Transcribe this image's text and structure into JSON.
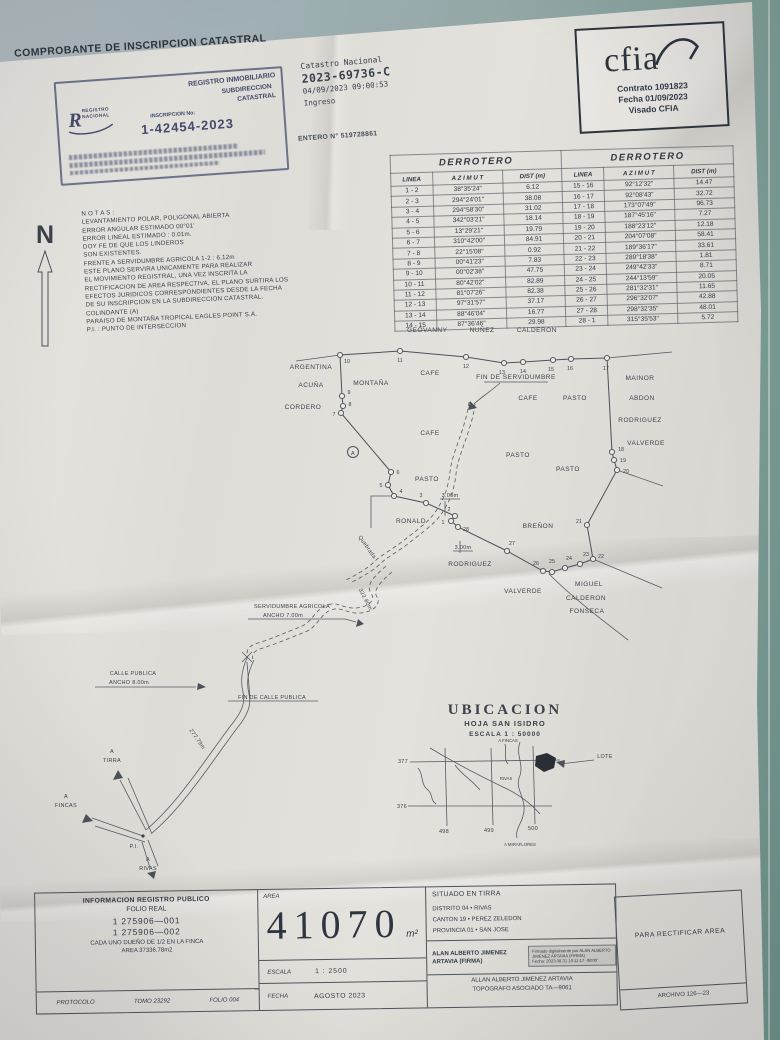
{
  "photo": {
    "surface_color": "#95a8a7",
    "paper_color": "#e0ded9",
    "ink_color": "#3c424b"
  },
  "header": {
    "title": "COMPROBANTE DE INSCRIPCION CATASTRAL",
    "stamp": {
      "org": "REGISTRO INMOBILIARIO",
      "org2": "SUBDIRECCION",
      "org3": "CATASTRAL",
      "logo1": "REGISTRO",
      "logo2": "NACIONAL",
      "inscripcion_label": "INSCRIPCION No:",
      "inscripcion_no": "1-42454-2023"
    },
    "catastro": "Catastro Nacional",
    "catastro_no": "2023-69736-C",
    "catastro_fecha": "04/09/2023 09:00:53",
    "catastro_estado": "Ingreso",
    "entero": "ENTERO N° 519728861"
  },
  "cfia": {
    "logo": "cfia",
    "contrato": "Contrato 1091823",
    "fecha": "Fecha 01/09/2023",
    "visado": "Visado CFIA"
  },
  "derrotero": {
    "title": "DERROTERO",
    "col_linea": "LINEA",
    "col_azimut": "A Z I M U T",
    "col_dist": "DIST (m)",
    "left_rows": [
      {
        "linea": "1 - 2",
        "azimut": "38°35'24\"",
        "dist": "6.12"
      },
      {
        "linea": "2 - 3",
        "azimut": "294°24'01\"",
        "dist": "38.08"
      },
      {
        "linea": "3 - 4",
        "azimut": "294°58'30\"",
        "dist": "31.02"
      },
      {
        "linea": "4 - 5",
        "azimut": "342°03'21\"",
        "dist": "18.14"
      },
      {
        "linea": "5 - 6",
        "azimut": "13°29'21\"",
        "dist": "19.79"
      },
      {
        "linea": "6 - 7",
        "azimut": "310°42'00\"",
        "dist": "84.91"
      },
      {
        "linea": "7 - 8",
        "azimut": "22°15'08\"",
        "dist": "0.92"
      },
      {
        "linea": "8 - 9",
        "azimut": "00°41'23\"",
        "dist": "7.83"
      },
      {
        "linea": "9 - 10",
        "azimut": "00°02'38\"",
        "dist": "47.75"
      },
      {
        "linea": "10 - 11",
        "azimut": "80°42'02\"",
        "dist": "82.89"
      },
      {
        "linea": "11 - 12",
        "azimut": "81°07'26\"",
        "dist": "82.38"
      },
      {
        "linea": "12 - 13",
        "azimut": "97°31'57\"",
        "dist": "37.17"
      },
      {
        "linea": "13 - 14",
        "azimut": "88°46'04\"",
        "dist": "16.77"
      },
      {
        "linea": "14 - 15",
        "azimut": "87°36'46\"",
        "dist": "29.98"
      }
    ],
    "right_rows": [
      {
        "linea": "15 - 16",
        "azimut": "92°12'32\"",
        "dist": "14.47"
      },
      {
        "linea": "16 - 17",
        "azimut": "92°08'43\"",
        "dist": "32.72"
      },
      {
        "linea": "17 - 18",
        "azimut": "173°07'49\"",
        "dist": "96.73"
      },
      {
        "linea": "18 - 19",
        "azimut": "187°45'16\"",
        "dist": "7.27"
      },
      {
        "linea": "19 - 20",
        "azimut": "188°23'12\"",
        "dist": "12.18"
      },
      {
        "linea": "20 - 21",
        "azimut": "204°07'08\"",
        "dist": "58.41"
      },
      {
        "linea": "21 - 22",
        "azimut": "189°36'17\"",
        "dist": "33.61"
      },
      {
        "linea": "22 - 23",
        "azimut": "289°18'38\"",
        "dist": "1.81"
      },
      {
        "linea": "23 - 24",
        "azimut": "249°42'33\"",
        "dist": "8.71"
      },
      {
        "linea": "24 - 25",
        "azimut": "244°13'59\"",
        "dist": "20.05"
      },
      {
        "linea": "25 - 26",
        "azimut": "281°32'31\"",
        "dist": "11.65"
      },
      {
        "linea": "26 - 27",
        "azimut": "296°32'07\"",
        "dist": "42.88"
      },
      {
        "linea": "27 - 28",
        "azimut": "298°32'35\"",
        "dist": "48.01"
      },
      {
        "linea": "28 - 1",
        "azimut": "315°35'53\"",
        "dist": "5.72"
      }
    ]
  },
  "notas": "N O T A S :\nLEVANTAMIENTO POLAR, POLIGONAL ABIERTA\nERROR ANGULAR ESTIMADO 00°01'\nERROR LINEAL ESTIMADO : 0.01m.\nDOY FE DE QUE LOS LINDEROS\nSON EXISTENTES.\nFRENTE A SERVIDUMBRE AGRICOLA 1-2 : 6.12m\nESTE PLANO SERVIRA UNICAMENTE PARA REALIZAR\nEL MOVIMIENTO REGISTRAL, UNA VEZ INSCRITA LA\nRECTIFICACION DE AREA RESPECTIVA, EL PLANO SURTIRA LOS\nEFECTOS JURIDICOS CORRESPONDIENTES DESDE LA FECHA\nDE SU INSCRIPCION EN LA SUBDIRECCION CATASTRAL.\nCOLINDANTE (A)\nPARAISO DE MONTAÑA TROPICAL EAGLES POINT S.A.\nP.I. : PUNTO DE INTERSECCION",
  "map": {
    "owner_top": "GEOVANNY NUÑEZ CALDERON",
    "labels": {
      "north": "N",
      "argentina": "ARGENTINA",
      "acuna": "ACUÑA",
      "cordero": "CORDERO",
      "montana": "MONTAÑA",
      "cafe1": "CAFE",
      "cafe2": "CAFE",
      "cafe3": "CAFE",
      "fin_servidumbre": "FIN DE SERVIDUMBRE",
      "pasto1": "PASTO",
      "pasto2": "PASTO",
      "pasto3": "PASTO",
      "pasto4": "PASTO",
      "mainor": "MAINOR",
      "abdon": "ABDON",
      "rodriguez_r": "RODRIGUEZ",
      "valverde_r": "VALVERDE",
      "ronald": "RONALD",
      "brenon": "BREÑON",
      "rodriguez_b": "RODRIGUEZ",
      "valverde_b": "VALVERDE",
      "miguel": "MIGUEL",
      "calderon": "CALDERON",
      "fonseca": "FONSECA",
      "serv1": "SERVIDUMBRE AGRICOLA",
      "serv2": "ANCHO 7.00m",
      "d322": "322.80m",
      "calle1": "CALLE PUBLICA",
      "calle2": "ANCHO 8.00m",
      "fin_calle": "FIN DE CALLE PUBLICA",
      "d277": "277.79m",
      "d3a": "3.00m",
      "d3b": "3.00m",
      "quebrada": "Quebrada",
      "colindante_a": "A",
      "a1": "A",
      "tirra": "TIRRA",
      "a2": "A",
      "fincas": "FINCAS",
      "a3": "A",
      "rivas": "RIVAS",
      "pi": "P.I."
    },
    "points": [
      {
        "n": "1",
        "x": 451,
        "y": 521,
        "lx": 443,
        "ly": 524
      },
      {
        "n": "2",
        "x": 455,
        "y": 516,
        "lx": 449,
        "ly": 511
      },
      {
        "n": "3",
        "x": 426,
        "y": 503,
        "lx": 421,
        "ly": 497
      },
      {
        "n": "4",
        "x": 394,
        "y": 496,
        "lx": 401,
        "ly": 493
      },
      {
        "n": "5",
        "x": 388,
        "y": 485,
        "lx": 381,
        "ly": 487
      },
      {
        "n": "6",
        "x": 391,
        "y": 472,
        "lx": 398,
        "ly": 474
      },
      {
        "n": "7",
        "x": 341,
        "y": 413,
        "lx": 334,
        "ly": 416
      },
      {
        "n": "8",
        "x": 343,
        "y": 406,
        "lx": 350,
        "ly": 406
      },
      {
        "n": "9",
        "x": 342,
        "y": 396,
        "lx": 349,
        "ly": 394
      },
      {
        "n": "10",
        "x": 340,
        "y": 355,
        "lx": 347,
        "ly": 363
      },
      {
        "n": "11",
        "x": 400,
        "y": 351,
        "lx": 400,
        "ly": 362
      },
      {
        "n": "12",
        "x": 466,
        "y": 357,
        "lx": 466,
        "ly": 368
      },
      {
        "n": "13",
        "x": 504,
        "y": 363,
        "lx": 502,
        "ly": 374
      },
      {
        "n": "14",
        "x": 523,
        "y": 362,
        "lx": 523,
        "ly": 373
      },
      {
        "n": "15",
        "x": 553,
        "y": 360,
        "lx": 551,
        "ly": 371
      },
      {
        "n": "16",
        "x": 571,
        "y": 359,
        "lx": 570,
        "ly": 370
      },
      {
        "n": "17",
        "x": 607,
        "y": 358,
        "lx": 606,
        "ly": 370
      },
      {
        "n": "18",
        "x": 612,
        "y": 452,
        "lx": 621,
        "ly": 451
      },
      {
        "n": "19",
        "x": 614,
        "y": 460,
        "lx": 623,
        "ly": 462
      },
      {
        "n": "20",
        "x": 617,
        "y": 470,
        "lx": 626,
        "ly": 473
      },
      {
        "n": "21",
        "x": 587,
        "y": 525,
        "lx": 579,
        "ly": 523
      },
      {
        "n": "22",
        "x": 593,
        "y": 559,
        "lx": 601,
        "ly": 558
      },
      {
        "n": "23",
        "x": 580,
        "y": 564,
        "lx": 586,
        "ly": 556
      },
      {
        "n": "24",
        "x": 565,
        "y": 568,
        "lx": 569,
        "ly": 560
      },
      {
        "n": "25",
        "x": 552,
        "y": 572,
        "lx": 552,
        "ly": 563
      },
      {
        "n": "26",
        "x": 543,
        "y": 571,
        "lx": 536,
        "ly": 565
      },
      {
        "n": "27",
        "x": 507,
        "y": 551,
        "lx": 512,
        "ly": 545
      },
      {
        "n": "28",
        "x": 458,
        "y": 527,
        "lx": 466,
        "ly": 531
      }
    ]
  },
  "ubicacion": {
    "title": "UBICACION",
    "hoja": "HOJA   SAN ISIDRO",
    "escala": "ESCALA 1 : 50000",
    "coord_377": "377",
    "coord_376": "376",
    "coord_498": "498",
    "coord_499": "499",
    "coord_500": "500",
    "lote": "LOTE",
    "rivas": "RIVAS",
    "a_fincas": "A FINCAS",
    "a_miraflores": "A MIRAFLORES"
  },
  "footer": {
    "info_title": "INFORMACION REGISTRO PUBLICO",
    "folio_real": "FOLIO REAL",
    "finca1": "1 275906—001",
    "finca2": "1 275906—002",
    "dueno": "CADA UNO DUEÑO DE 1/2 EN LA FINCA",
    "area_finca": "AREA 37336.78m2",
    "protocolo": "PROTOCOLO",
    "tomo": "TOMO 23292",
    "folio": "FOLIO 004",
    "area_label": "AREA",
    "area_value": "41070",
    "area_unit": "m²",
    "escala_label": "ESCALA",
    "escala_value": "1 : 2500",
    "fecha_label": "FECHA",
    "fecha_value": "AGOSTO 2023",
    "situado": "SITUADO EN TIRRA",
    "distrito": "DISTRITO 04 • RIVAS",
    "canton": "CANTON 19 • PEREZ ZELEDON",
    "provincia": "PROVINCIA 01 • SAN JOSE",
    "firmante1": "ALAN ALBERTO JIMENEZ",
    "firmante2": "ARTAVIA (FIRMA)",
    "firma_digital": "Firmado digitalmente por ALAN ALBERTO\nJIMENEZ ARTAVIA (FIRMA)\nFecha: 2023.08.31 10:11:17 -06'00'",
    "topografo1": "ALLAN ALBERTO JIMENEZ ARTAVIA",
    "topografo2": "TOPOGRAFO ASOCIADO TA—9061",
    "para_rectificar": "PARA RECTIFICAR AREA",
    "archivo": "ARCHIVO 126—23"
  }
}
